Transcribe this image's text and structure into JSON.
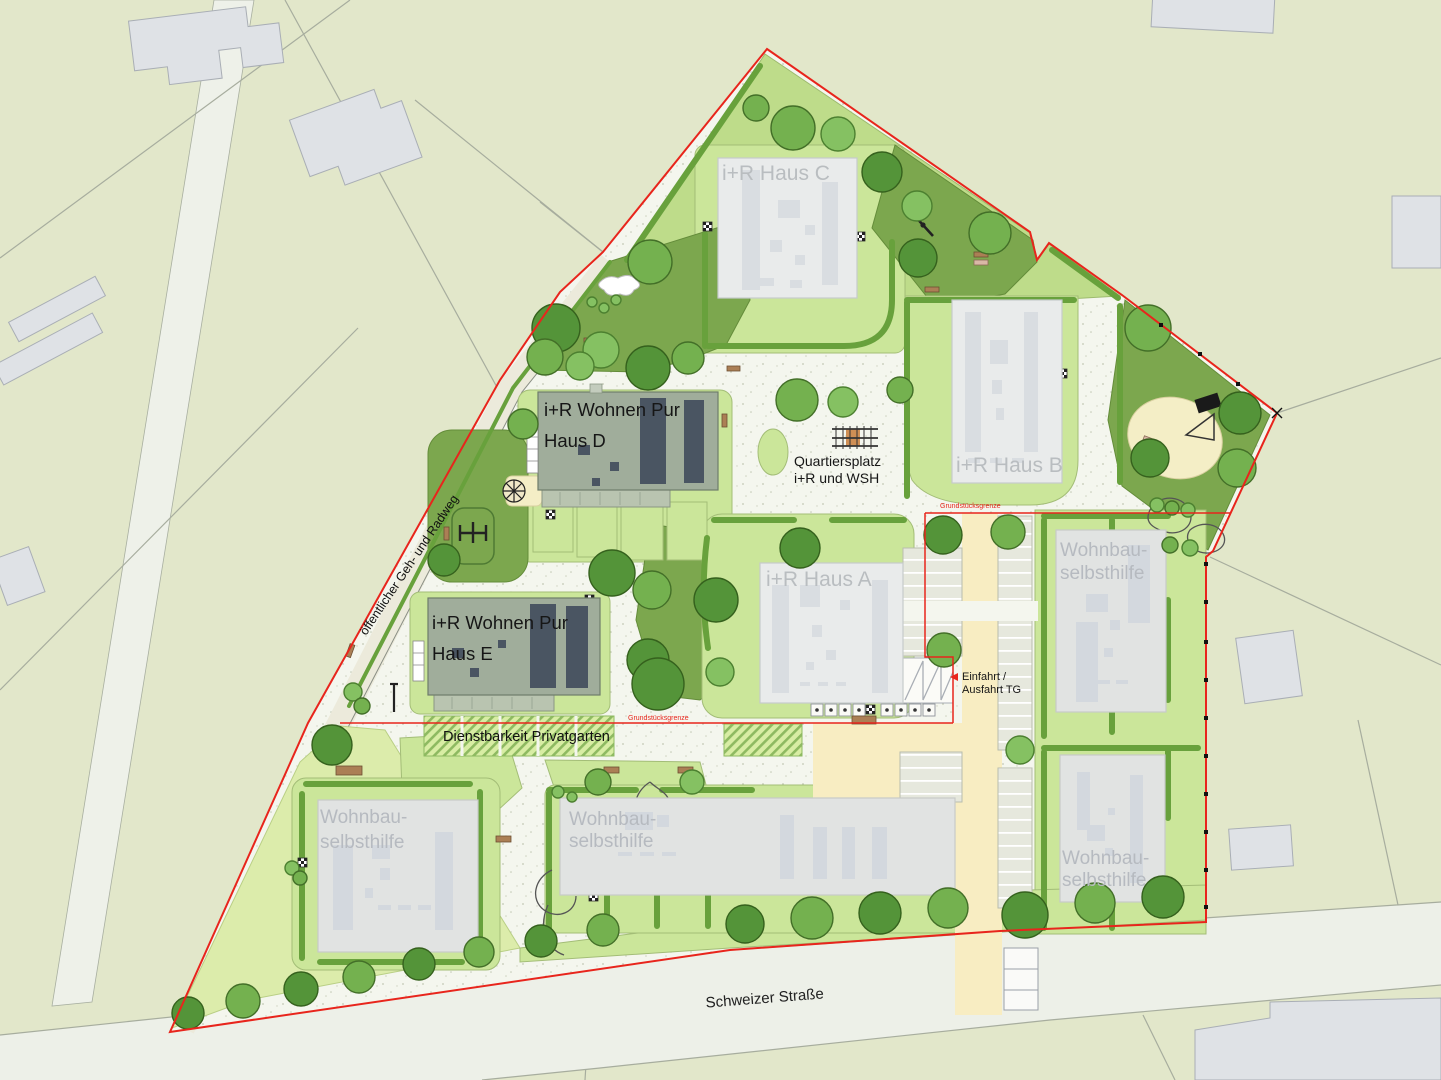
{
  "site": {
    "buildings": {
      "haus_c": "i+R  Haus C",
      "haus_b": "i+R  Haus B",
      "haus_a": "i+R  Haus A",
      "wohnen_pur": "i+R Wohnen Pur",
      "haus_d": "Haus D",
      "haus_e": "Haus E",
      "wsh1": "Wohnbau-",
      "wsh2": "selbsthilfe"
    },
    "labels": {
      "quartiersplatz1": "Quartiersplatz",
      "quartiersplatz2": "i+R und WSH",
      "einfahrt1": "Einfahrt /",
      "einfahrt2": "Ausfahrt TG",
      "dienstbarkeit": "Dienstbarkeit Privatgarten",
      "strasse": "Schweizer Straße",
      "radweg": "öffentlicher Geh- und Radweg",
      "grenze": "Grundstücksgrenze"
    },
    "colors": {
      "boundary_red": "#e8251c",
      "lawn_light": "#cbe69a",
      "lawn_dark": "#7ca74e",
      "driveway_yellow": "#f8edc2",
      "building_gray": "#e1e3e2",
      "wohnen_pur_roof": "#a0ad9b",
      "sand": "#f4eec6"
    }
  }
}
